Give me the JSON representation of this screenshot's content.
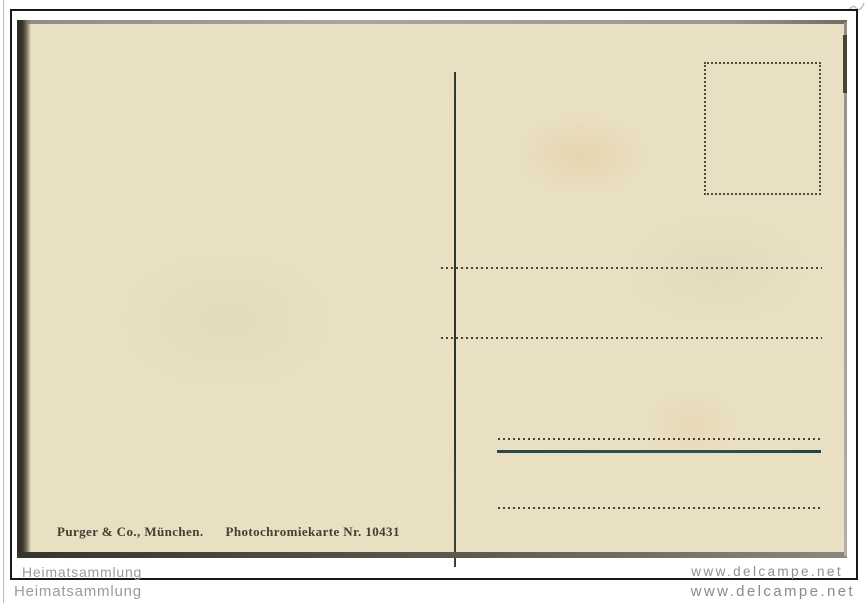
{
  "postcard": {
    "publisher_line": {
      "publisher": "Purger & Co., München.",
      "card_info": "Photochromiekarte Nr. 10431"
    },
    "colors": {
      "paper": "#e9dfc3",
      "frame": "#191919",
      "divider": "#2c3326",
      "dotted_lines": "#4b4134",
      "message_rule": "#3a5048",
      "publisher_text": "#444033"
    },
    "lines": {
      "address_dotted_count": 4,
      "solid_rule_count": 1
    }
  },
  "watermarks": {
    "inner_left": "Heimatsammlung",
    "inner_right": "www.delcampe.net",
    "outer_left": "Heimatsammlung",
    "outer_right": "www.delcampe.net",
    "color": "#9c9c9c"
  }
}
